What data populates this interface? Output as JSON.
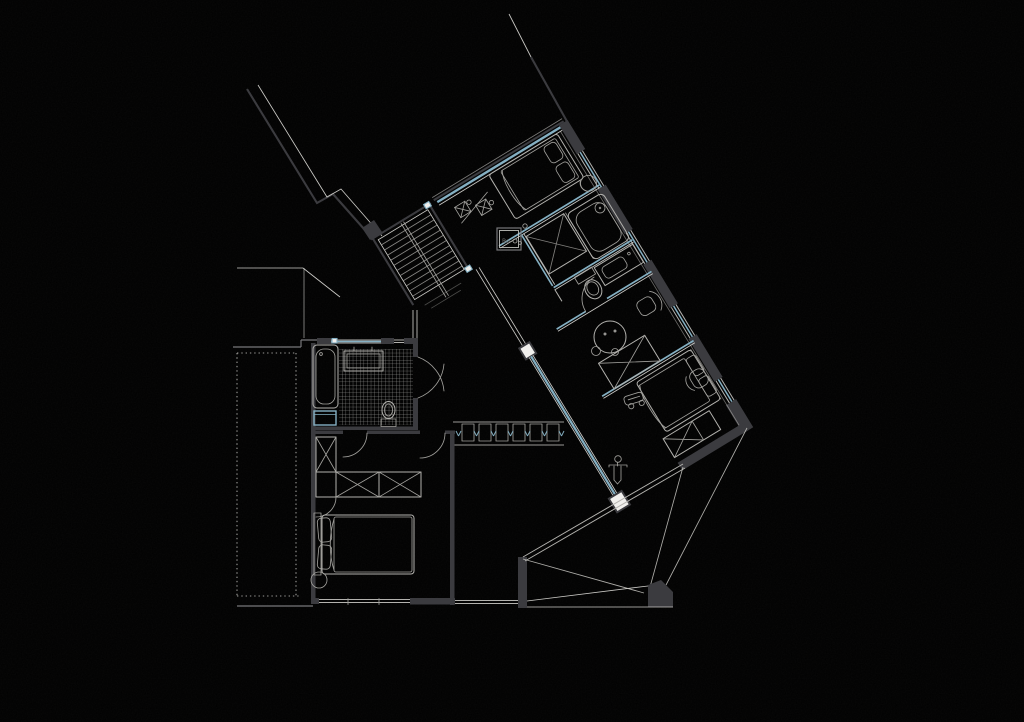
{
  "canvas": {
    "width": 1024,
    "height": 722
  },
  "colors": {
    "paper": "#f1f0ed",
    "wall": "#3b3b3f",
    "wall_medium": "#77777a",
    "line_light": "#b3b2ae",
    "line_faint": "#cbcac6",
    "blue": "#85b0c3",
    "blue_soft": "#b8d2dd",
    "tile": "#d8d7d3",
    "glyph": "#72716e"
  },
  "plan": {
    "utility_box_label": "Bo",
    "stair_tread_count": 11,
    "closet_module_count": 6,
    "ne_window_pier_count": 4,
    "fixtures": [
      "staircase",
      "bathtub",
      "shower",
      "vanity-sink",
      "toilet",
      "washing-machine",
      "double-bed",
      "wardrobe",
      "closet-row",
      "round-table",
      "stool",
      "desk-chair",
      "lounge-chair",
      "bench",
      "toy-car",
      "person-figure",
      "utility-box"
    ]
  }
}
